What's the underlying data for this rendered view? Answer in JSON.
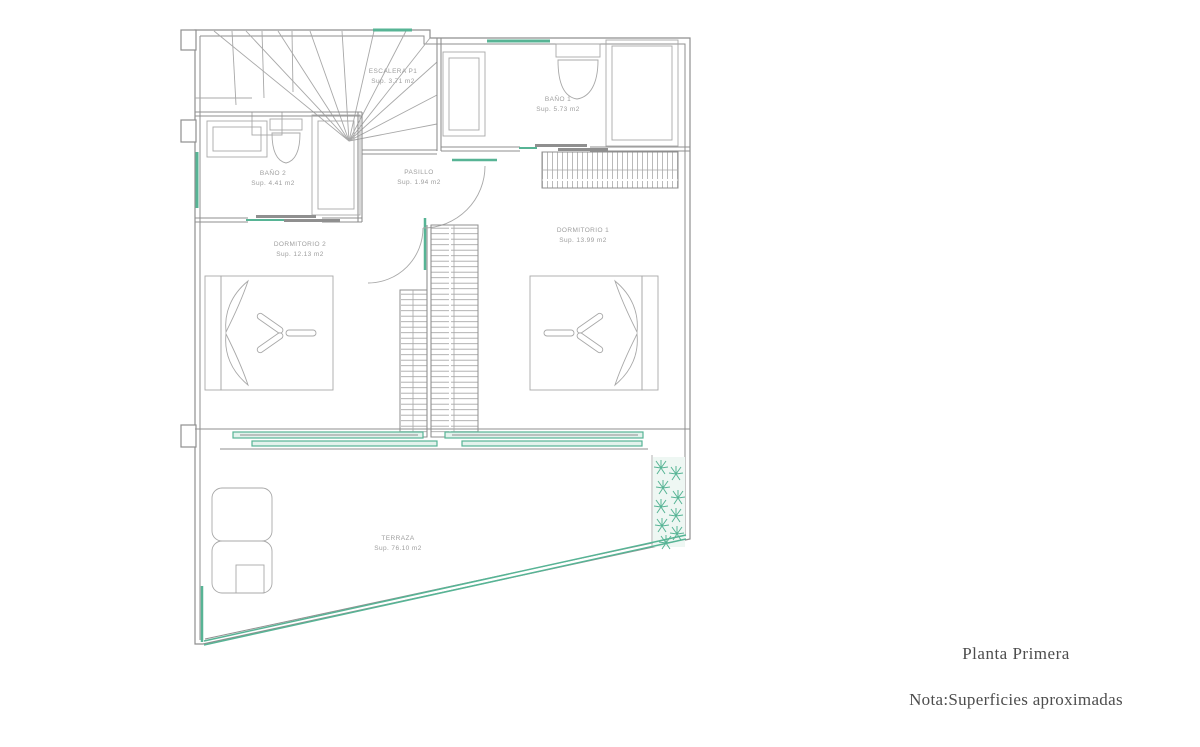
{
  "footer": {
    "title": "Planta Primera",
    "note": "Nota:Superficies aproximadas"
  },
  "rooms": {
    "escalera": {
      "name": "ESCALERA P1",
      "area": "Sup. 3.71 m2"
    },
    "bano1": {
      "name": "BAÑO 1",
      "area": "Sup. 5.73 m2"
    },
    "bano2": {
      "name": "BAÑO 2",
      "area": "Sup. 4.41 m2"
    },
    "pasillo": {
      "name": "PASILLO",
      "area": "Sup. 1.94 m2"
    },
    "dormitorio1": {
      "name": "DORMITORIO 1",
      "area": "Sup. 13.99 m2"
    },
    "dormitorio2": {
      "name": "DORMITORIO 2",
      "area": "Sup. 12.13 m2"
    },
    "terraza": {
      "name": "TERRAZA",
      "area": "Sup. 76.10 m2"
    }
  },
  "colors": {
    "accent_teal": "#57b495",
    "accent_teal_fill": "#e3f2ec",
    "wall_gray": "#8f8f8f",
    "line_gray": "#a8a8a8",
    "label_gray": "#9e9e9e",
    "footer_text": "#4d4d4d"
  }
}
